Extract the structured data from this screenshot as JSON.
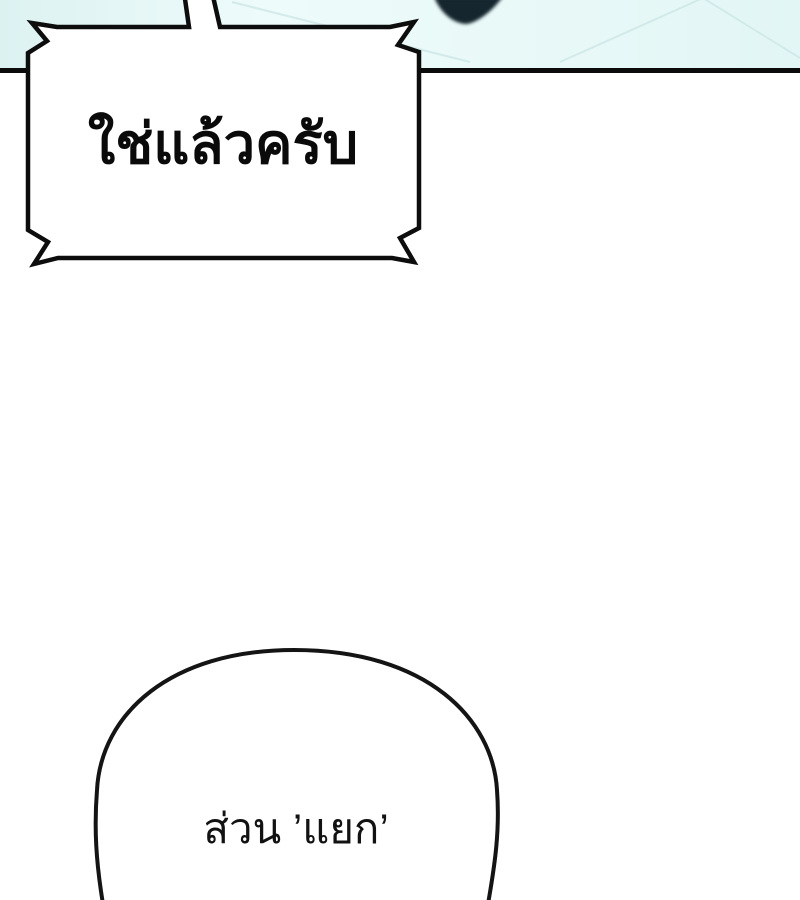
{
  "page": {
    "kind": "comic-panel",
    "background_color": "#ffffff",
    "panel_border_color": "#0b0b0b"
  },
  "scene": {
    "background_color": "#e3f6f5",
    "highlight_color": "#f1fcfc",
    "tile_line_color": "#cfe9e8",
    "dark_object_color": "#18262f"
  },
  "bubbles": {
    "shout": {
      "style": "jagged-rectangle",
      "fill": "#ffffff",
      "stroke": "#0d0d0d",
      "text": "ใช่แล้วครับ"
    },
    "aside": {
      "style": "rounded",
      "fill": "#ffffff",
      "stroke": "#141414",
      "text": "ส่วน ’แยก’"
    }
  }
}
